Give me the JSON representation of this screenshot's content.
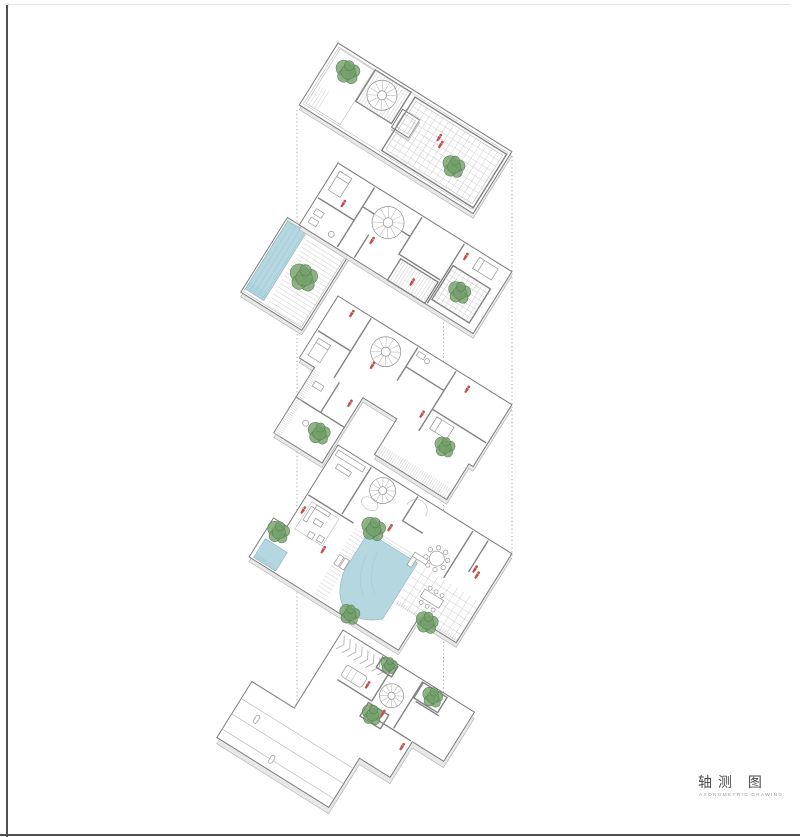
{
  "title_block": {
    "title": "轴测 图",
    "subtitle": "AXONOMETRIC DRAWING"
  },
  "levels": [
    {
      "id": "roof-plan"
    },
    {
      "id": "second-floor"
    },
    {
      "id": "first-floor"
    },
    {
      "id": "ground-floor"
    },
    {
      "id": "basement"
    }
  ],
  "colors": {
    "title": "#4a4a4a",
    "subtitle": "#9a9a9a",
    "border_dark": "#4f4f4f",
    "border_light": "#e4e4e4",
    "slab_side": "#e8e8e8",
    "pool": "#b5d8e0",
    "pool_edge": "#8fb9c6",
    "tree": "#75a06b",
    "tree_dark": "#4f7d4c",
    "figure": "#c4504e"
  }
}
